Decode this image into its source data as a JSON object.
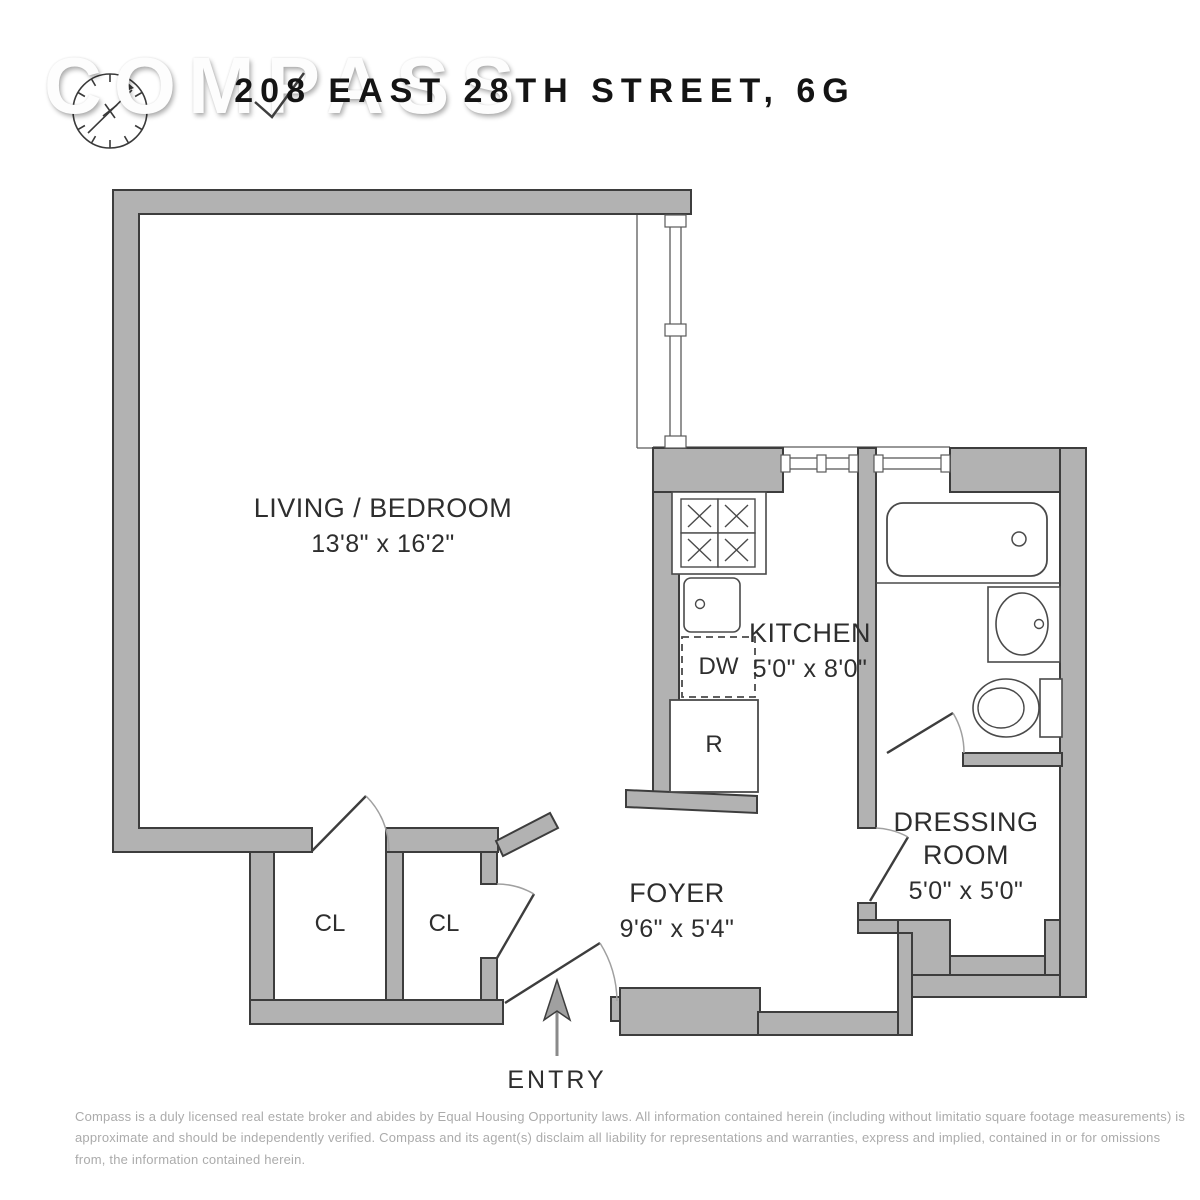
{
  "header": {
    "watermark": "COMPASS",
    "title": "208 EAST 28TH STREET, 6G"
  },
  "icons": {
    "logo": "compass-dial-icon",
    "entry": "entry-arrow-icon"
  },
  "rooms": {
    "living": {
      "name": "LIVING / BEDROOM",
      "dims": "13'8\" x 16'2\""
    },
    "kitchen": {
      "name": "KITCHEN",
      "dims": "5'0\" x 8'0\""
    },
    "dressing": {
      "name": "DRESSING ROOM",
      "dims": "5'0\" x 5'0\""
    },
    "foyer": {
      "name": "FOYER",
      "dims": "9'6\" x 5'4\""
    },
    "closet_left": {
      "label": "CL"
    },
    "closet_right": {
      "label": "CL"
    }
  },
  "fixtures": {
    "dishwasher_label": "DW",
    "refrigerator_label": "R"
  },
  "entry": {
    "label": "ENTRY"
  },
  "footer": {
    "disclaimer_lines": [
      "Compass is a duly licensed real estate broker and abides by Equal Housing Opportunity laws. All information contained herein (including without limitatio square footage measurements) is",
      "approximate and should be independently verified. Compass and its agent(s) disclaim all liability for representations and warranties, express and implied, contained in or for omissions",
      "from, the information contained herein."
    ]
  },
  "colors": {
    "wall_fill": "#b2b2b2",
    "wall_stroke": "#3d3d3d",
    "fixture_stroke": "#4a4a4a",
    "door_arc": "#a0a0a0",
    "label_text": "#2e2e2e",
    "title_text": "#141414",
    "disclaimer_text": "#ababab",
    "background": "#ffffff"
  }
}
